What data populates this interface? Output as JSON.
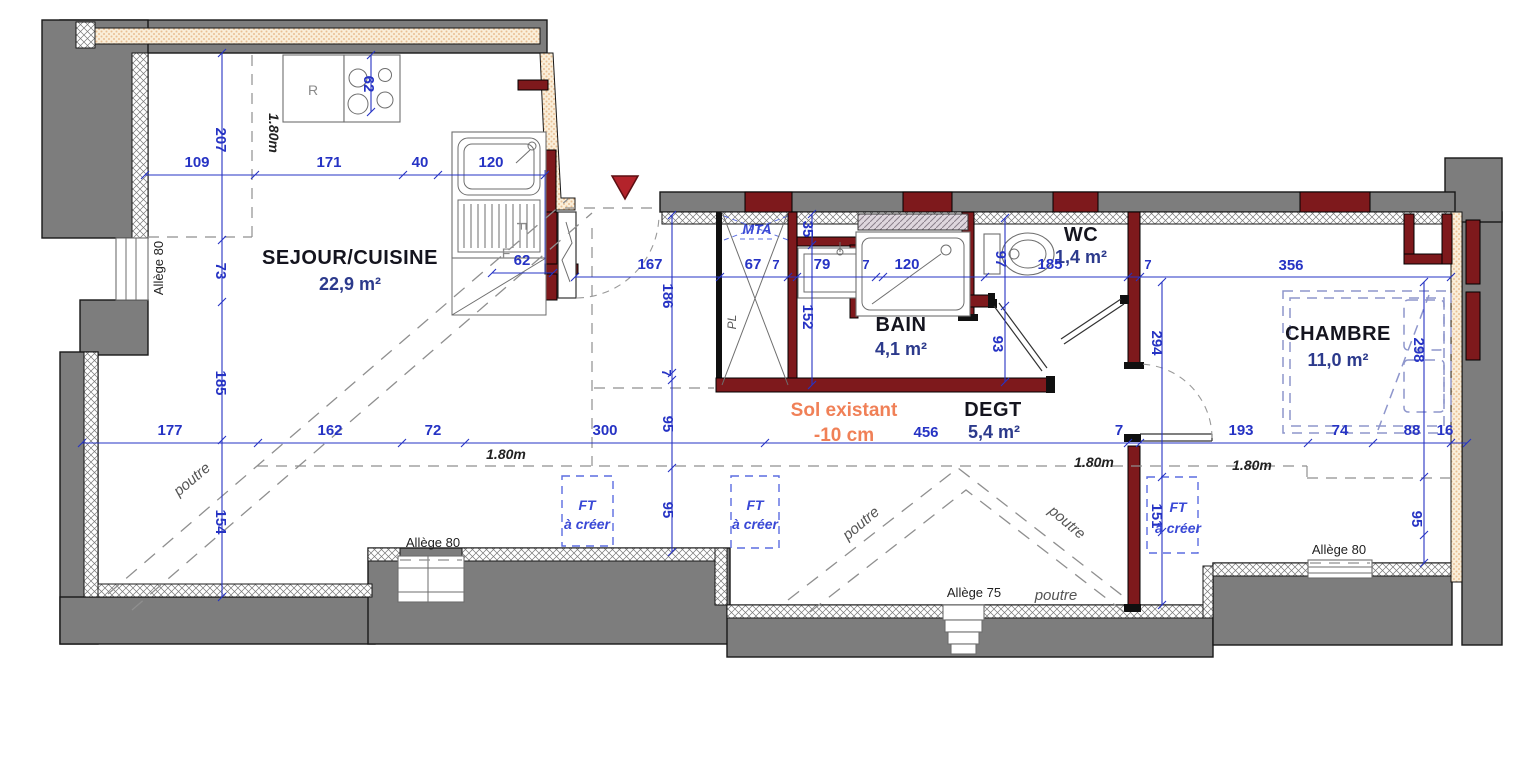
{
  "rooms": [
    {
      "name": "SEJOUR/CUISINE",
      "area": "22,9 m²"
    },
    {
      "name": "BAIN",
      "area": "4,1 m²"
    },
    {
      "name": "WC",
      "area": "1,4 m²"
    },
    {
      "name": "DEGT",
      "area": "5,4 m²"
    },
    {
      "name": "CHAMBRE",
      "area": "11,0 m²"
    }
  ],
  "floor_note": {
    "title": "Sol existant",
    "value": "-10 cm"
  },
  "annotations": {
    "mta": "MTA",
    "pl": "PL",
    "poutre": "poutre",
    "ft_line1": "FT",
    "ft_line2": "à créer",
    "allege_80": "Allège 80",
    "allege_75": "Allège 75",
    "height_line": "1.80m",
    "fridge": "R",
    "oven": "F"
  },
  "dims": {
    "kt": [
      "109",
      "171",
      "40",
      "120"
    ],
    "kl": [
      "207",
      "73",
      "185",
      "154"
    ],
    "stove": "62",
    "sink": "62",
    "main": [
      "177",
      "162",
      "72",
      "300",
      "456",
      "7",
      "193",
      "74",
      "88",
      "16"
    ],
    "cor": [
      "167",
      "67",
      "7",
      "79",
      "7",
      "120",
      "185",
      "7",
      "356"
    ],
    "ent": [
      "186",
      "7",
      "95",
      "95"
    ],
    "bath": [
      "35",
      "152"
    ],
    "wc": [
      "97",
      "93"
    ],
    "chl": [
      "294",
      "151"
    ],
    "chr": [
      "298",
      "95"
    ]
  },
  "colors": {
    "dimension_blue": "#2633c4",
    "new_wall_red": "#7e191c",
    "wall_gray": "#7d7d7d",
    "note_orange": "#f08057",
    "insulation_beige": "#f6e3c2"
  }
}
